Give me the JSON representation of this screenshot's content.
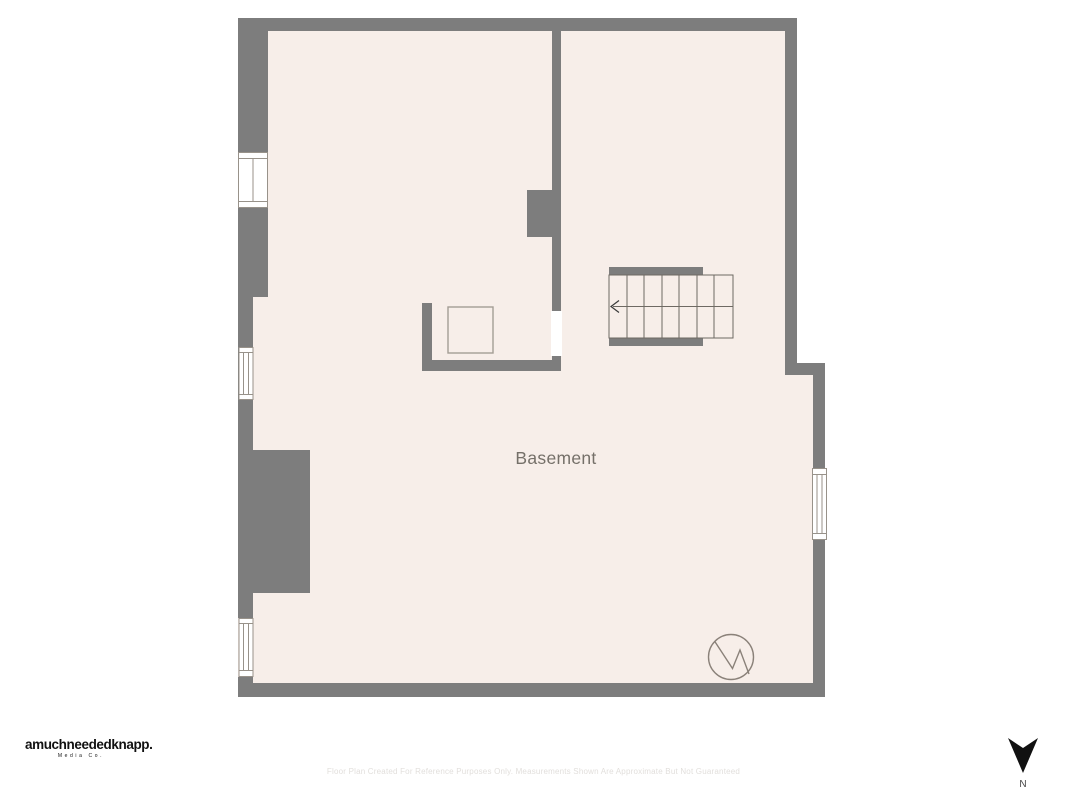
{
  "colors": {
    "canvas_bg": "#ffffff",
    "wall": "#7d7d7d",
    "floor": "#f7eee9",
    "window_fill": "#ffffff",
    "window_frame": "#98928a",
    "stair_line": "#6e6963",
    "room_label": "#757069",
    "fixture_outline": "#a49d94",
    "compass": "#8a8179",
    "logo_text": "#111111",
    "disclaimer_text": "#e2dfdc",
    "north_arrow": "#111111",
    "north_label": "#444444"
  },
  "plan": {
    "room_label": "Basement",
    "stairs": {
      "steps": 7,
      "direction": "left"
    },
    "windows_count": 4,
    "compass_label": "N"
  },
  "footer": {
    "logo_line1": "amuchneededknapp.",
    "logo_line2": "Media Co.",
    "disclaimer": "Floor Plan Created For Reference Purposes Only. Measurements Shown Are Approximate But Not Guaranteed"
  }
}
